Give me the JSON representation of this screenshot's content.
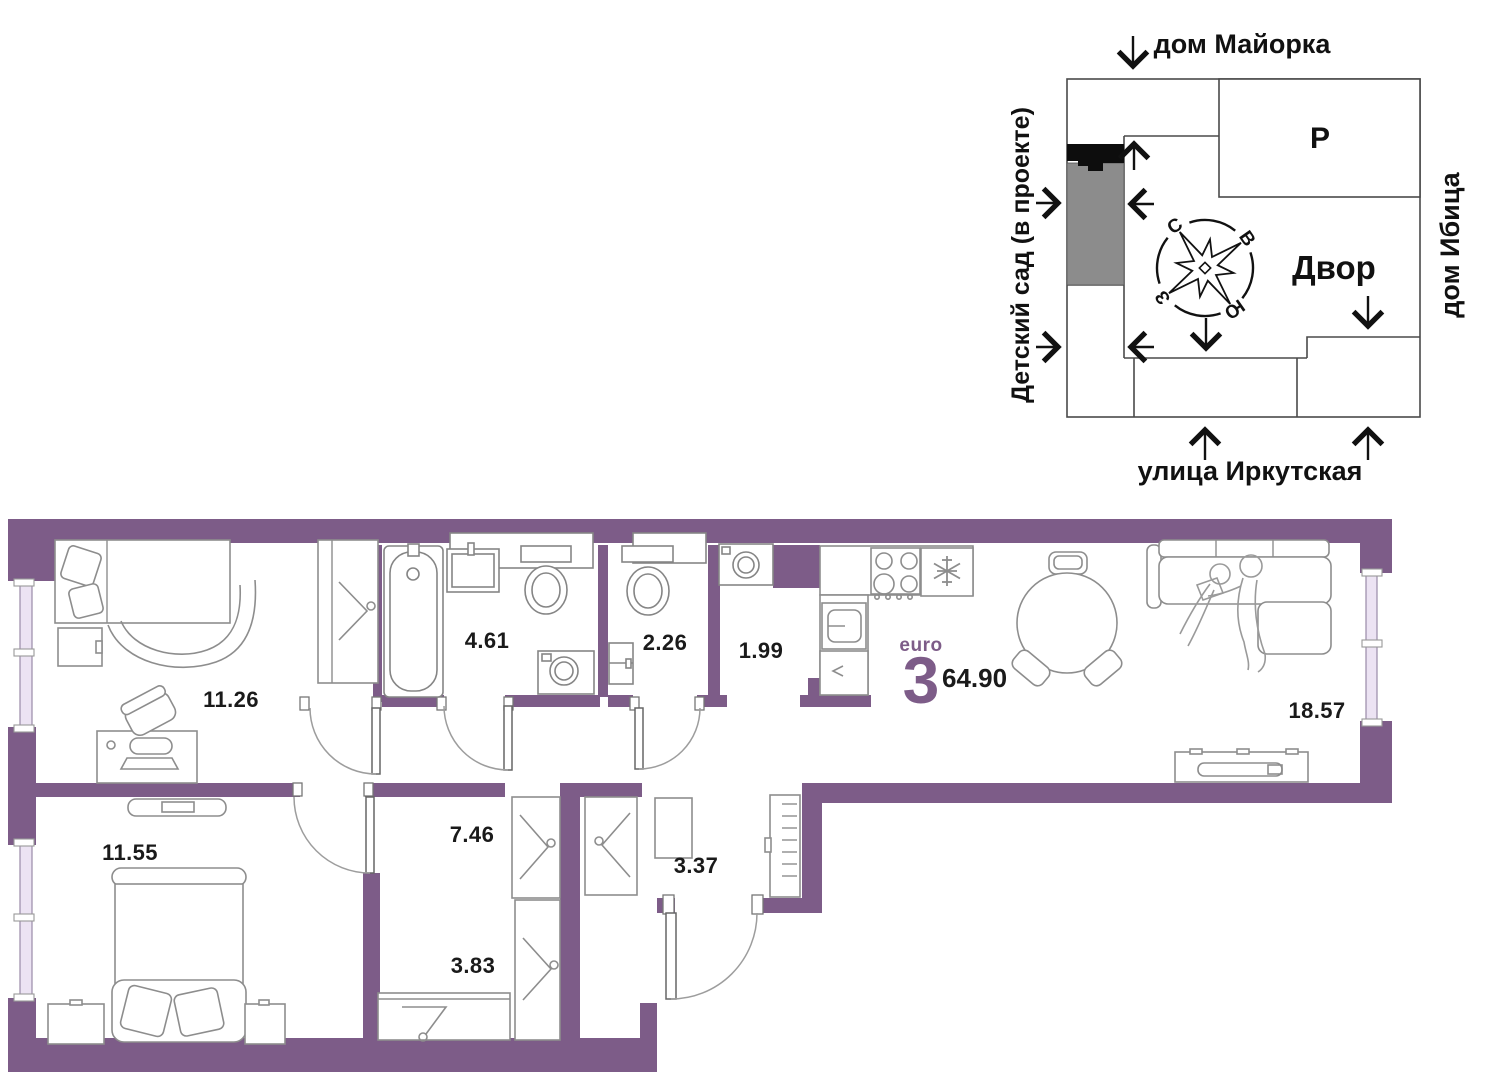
{
  "site_plan": {
    "building_top": "дом Майорка",
    "building_right": "дом Ибица",
    "street_bottom": "улица Иркутская",
    "area_left": "Детский сад (в проекте)",
    "courtyard": "Двор",
    "parking": "Р",
    "compass": {
      "north": "С",
      "east": "В",
      "south": "Ю",
      "west": "З"
    }
  },
  "apartment": {
    "layout_type": "euro",
    "room_count": "3",
    "total_area": "64.90"
  },
  "rooms": [
    {
      "name": "bedroom-1",
      "area": "11.26"
    },
    {
      "name": "bathroom",
      "area": "4.61"
    },
    {
      "name": "wc",
      "area": "2.26"
    },
    {
      "name": "laundry",
      "area": "1.99"
    },
    {
      "name": "kitchen-living-room",
      "area": "18.57"
    },
    {
      "name": "corridor",
      "area": "7.46"
    },
    {
      "name": "entry-hall",
      "area": "3.37"
    },
    {
      "name": "bedroom-2",
      "area": "11.55"
    },
    {
      "name": "wardrobe-room",
      "area": "3.83"
    }
  ],
  "colors": {
    "wall": "#7d5c88",
    "accent_text": "#7d5c88",
    "label_text": "#1a1a1a",
    "highlight_gray": "#8c8c8c",
    "highlight_black": "#0d0d0d"
  }
}
